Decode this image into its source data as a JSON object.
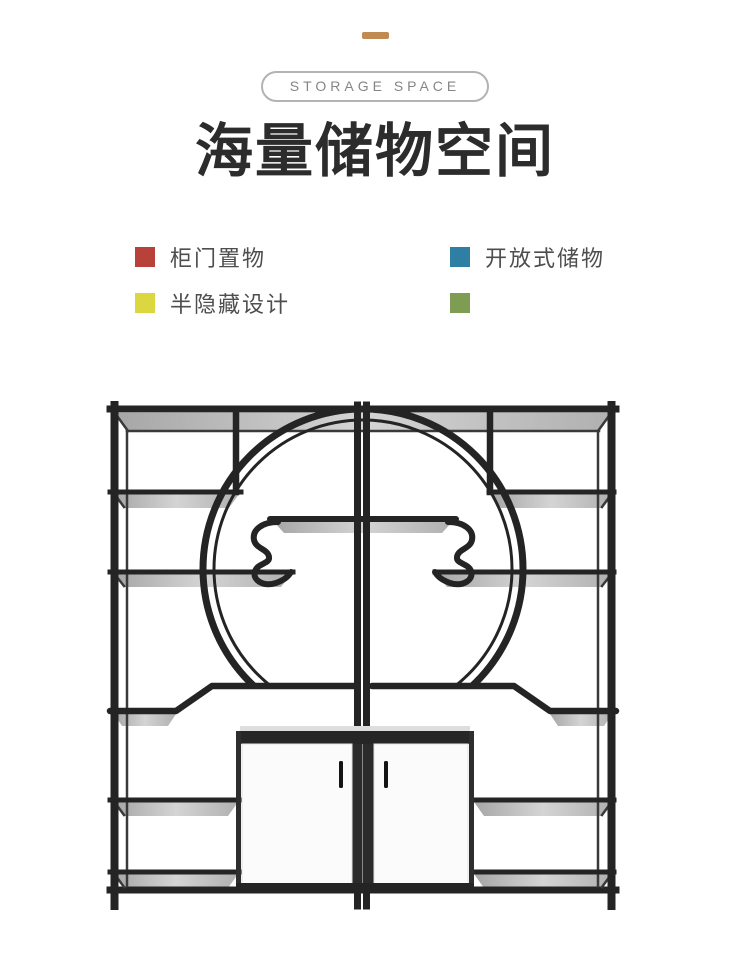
{
  "page": {
    "background": "#ffffff"
  },
  "header": {
    "accent_dash_color": "#c18a52",
    "badge_label": "STORAGE SPACE",
    "title": "海量储物空间"
  },
  "features": [
    {
      "color": "#b8413a",
      "label": "柜门置物"
    },
    {
      "color": "#2f7fa4",
      "label": "开放式储物"
    },
    {
      "color": "#dcd640",
      "label": "半隐藏设计"
    },
    {
      "color": "#7e9d52",
      "label": ""
    }
  ],
  "illustration": {
    "name": "moon-gate-display-shelf",
    "frame_color": "#242424",
    "shelf_surface_color": "#c4c4c4",
    "cabinet_color": "#fbfbfb"
  }
}
